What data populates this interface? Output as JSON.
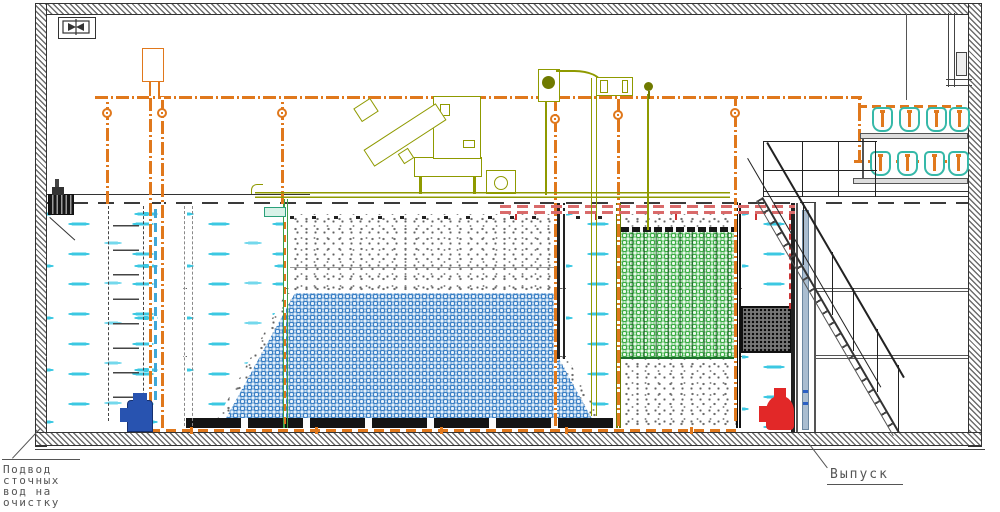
{
  "drawing": {
    "title": "Wastewater treatment plant — longitudinal section (CAD drawing)",
    "labels": {
      "inlet": {
        "line1": "Подвод",
        "line2": "сточных",
        "line3": "вод на",
        "line4": "очистку"
      },
      "outlet": {
        "text": "Выпуск"
      }
    },
    "icons": [
      "fan-icon",
      "valve-icon",
      "blower-icon",
      "pump-icon",
      "ladder-icon",
      "staircase-icon"
    ],
    "colors": {
      "wall_hatch_gray": "#6d6d6d",
      "air_pipe_orange": "#e0781c",
      "equipment_olive": "#8f9a00",
      "blower_teal": "#35b8a8",
      "water_dash_cyan": "#3cc8e2",
      "blue_media": "#3b7fc4",
      "green_media": "#3cab46",
      "recycle_pipe_pink": "#d96a6a",
      "inlet_pump_blue": "#2853b0",
      "outlet_pump_red": "#e22828",
      "label_gray": "#555555"
    }
  }
}
